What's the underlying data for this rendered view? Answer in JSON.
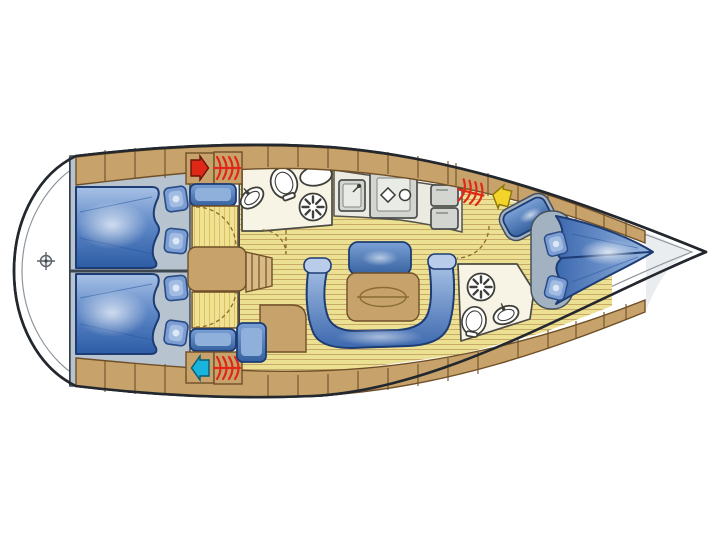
{
  "window": {
    "width": 720,
    "height": 540,
    "background": "#ffffff"
  },
  "floorplan": {
    "subject": "sailing-yacht-interior-layout-top-view",
    "orientation": {
      "bow": "right",
      "stern": "left"
    },
    "compartments": [
      {
        "name": "stern-platform",
        "fixtures": [
          "steering-compass-symbol"
        ]
      },
      {
        "name": "aft-cabin-upper",
        "fixtures": [
          "double-berth",
          "pillow",
          "pillow",
          "vanity-basin",
          "wardrobe-with-door-swing",
          "vent-red",
          "heater-coil"
        ]
      },
      {
        "name": "aft-cabin-lower",
        "fixtures": [
          "double-berth",
          "pillow",
          "pillow",
          "vanity-basin",
          "wardrobe-with-door-swing",
          "vent-cyan",
          "heater-coil"
        ]
      },
      {
        "name": "companionway",
        "fixtures": [
          "steps"
        ]
      },
      {
        "name": "head-forward",
        "fixtures": [
          "washbasin",
          "toilet",
          "vanity-oval",
          "shower-fan",
          "door-swing"
        ]
      },
      {
        "name": "galley",
        "fixtures": [
          "sink",
          "two-burner-stove",
          "fridge-box",
          "fridge-box",
          "heater-coil",
          "vent-yellow"
        ]
      },
      {
        "name": "saloon",
        "fixtures": [
          "u-shaped-settee",
          "backrest-cushion",
          "table-with-oval-inlay",
          "nav-desk",
          "nav-seat",
          "teak-striped-floor"
        ]
      },
      {
        "name": "head-aft",
        "fixtures": [
          "shower-fan",
          "toilet",
          "washbasin"
        ]
      },
      {
        "name": "fore-cabin",
        "fixtures": [
          "v-berth",
          "pillow",
          "pillow",
          "headboard",
          "seat-cushion",
          "door-swing"
        ]
      },
      {
        "name": "bow-locker",
        "fixtures": []
      }
    ]
  },
  "icons": {
    "heater_coil": "heater-coil-icon",
    "vent_red": "vent-arrow-icon-red",
    "vent_cyan": "vent-arrow-icon-cyan",
    "vent_yellow": "vent-arrow-icon-yellow",
    "shower_fan": "shower-fan-icon",
    "compass": "steering-compass-icon"
  },
  "colors": {
    "outline": "#23282e",
    "innerline": "#8e969e",
    "wood": "#c7a36b",
    "wood-dark": "#6f4f28",
    "wood-light": "#d9ba84",
    "cabin-floor": "#b7c3cf",
    "wall": "#3c4750",
    "teak": "#ece193",
    "teak-stripe": "#c9a968",
    "wardrobe": "#f0e292",
    "wardrobe-stripe": "#d8c162",
    "ivory": "#f7f4e6",
    "counter": "#ebebe2",
    "appliance": "#d3d5d1",
    "berth-line": "#1d3c74",
    "pillow": "#7b9dd4",
    "pillow-line": "#2a4c85",
    "gray-base": "#a3b2c0",
    "red": "#e02818",
    "cyan": "#18b4dc",
    "yellow": "#f2d42b"
  }
}
